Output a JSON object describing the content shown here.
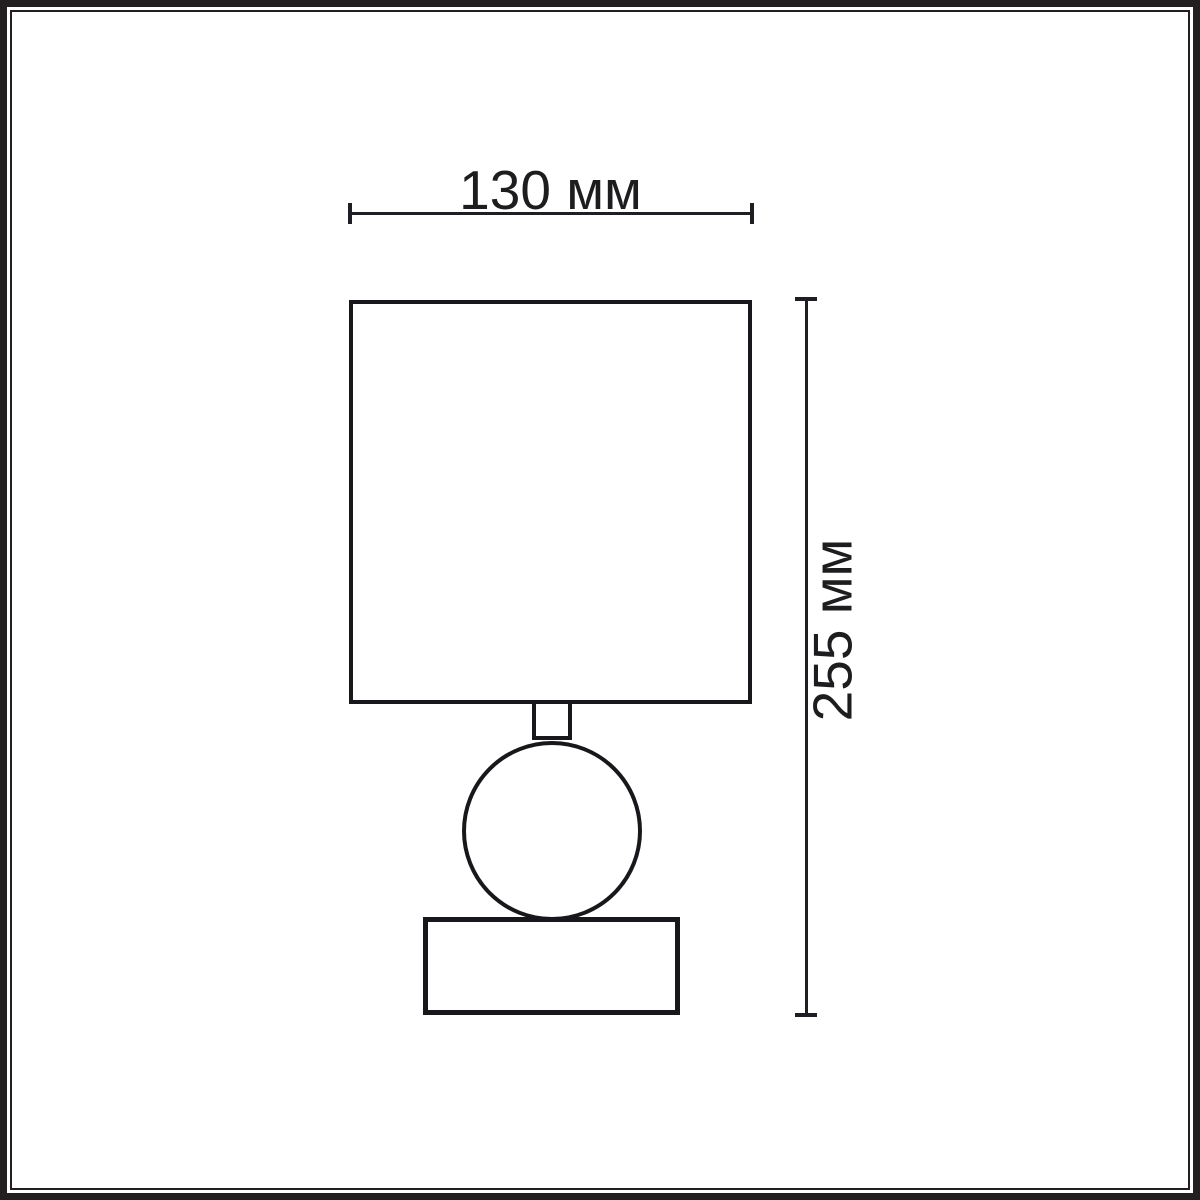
{
  "diagram": {
    "kind": "table-lamp-dimension-drawing",
    "width_dimension": {
      "label": "130 мм"
    },
    "height_dimension": {
      "label": "255 мм"
    },
    "parts": [
      "lampshade",
      "neck",
      "ball",
      "base"
    ]
  },
  "colors": {
    "background": "#ffffff",
    "stroke": "#18181c",
    "frame": "#231f20",
    "text": "#1d1d1f"
  }
}
